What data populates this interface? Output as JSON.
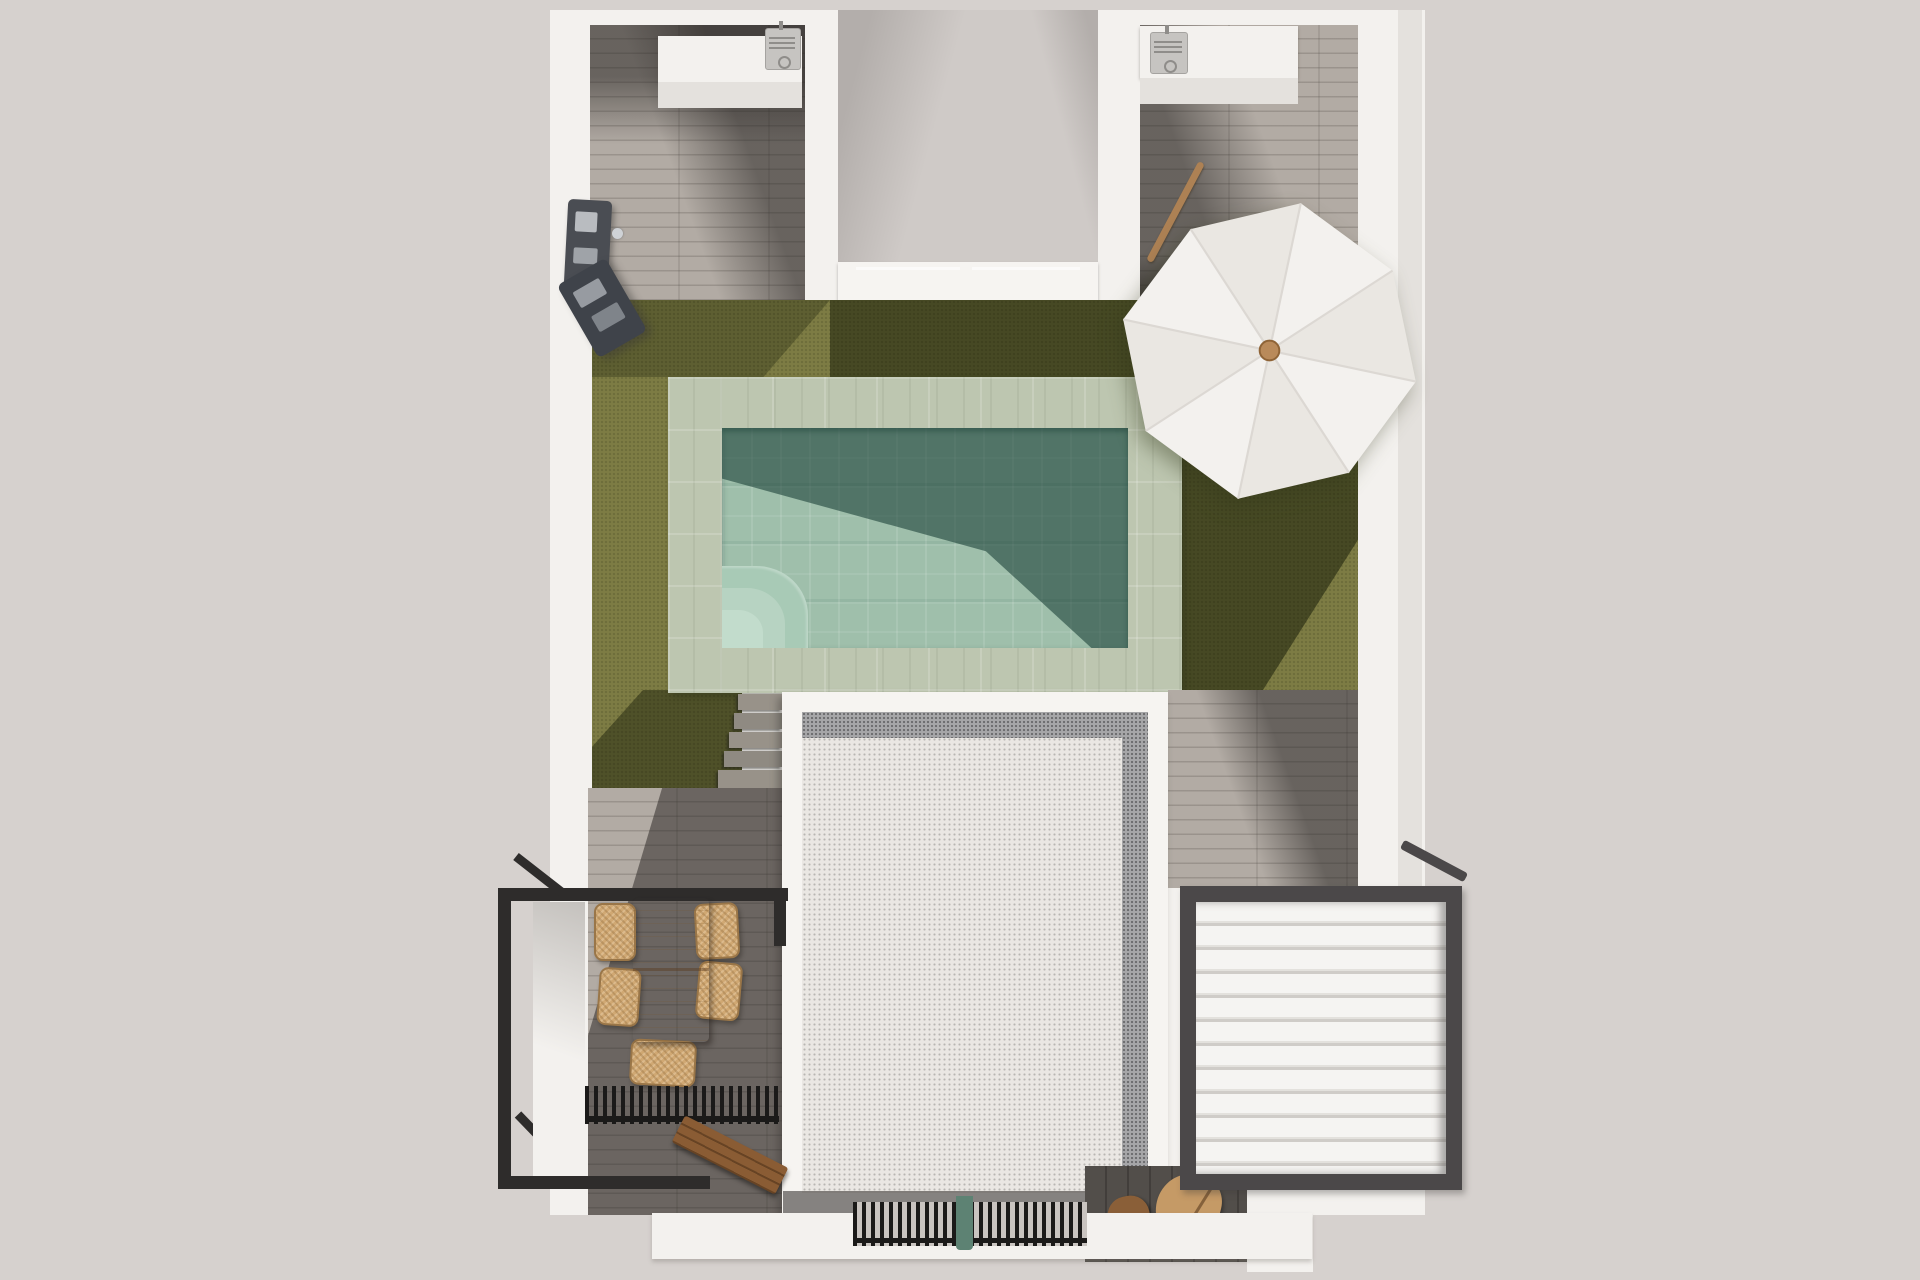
{
  "title": "Aerial 3D render — villa roof terrace with swimming pool, lawn, dining set, parasol and louvered pergola",
  "colors": {
    "ground": "#d6d1ce",
    "wall": "#f3f1ee",
    "wall-face": "#e4e1dd",
    "recess": "#cfcac7",
    "recess-shade": "#b3aeab",
    "parapet": "#f6f4f1",
    "wood": "#b2aba4",
    "wood-line": "rgba(80,74,68,0.25)",
    "shadow-dark": "rgba(36,33,31,0.52)",
    "lawn": "#7d7c44",
    "lawn-shadow": "rgba(16,22,4,0.5)",
    "pool-stone": "#bdc6b0",
    "pool-water": "#9fbfab",
    "pool-shadow": "rgba(10,48,40,0.52)",
    "pool-step": "#b7d3c2",
    "gravel": "#eae7e3",
    "gravel-dark": "#a6a6a8",
    "pergola-frame": "#4b4849",
    "louver": "#f5f4f2",
    "louver-gap": "#cfccc8",
    "railing": "#2e2c2b",
    "table-wood": "#c49a63",
    "chair-wicker": "#d0a873",
    "chair-edge": "#9a7648",
    "bench-wood": "#8a5c34",
    "board-light": "#c59a66",
    "board-dark": "#8a5f38",
    "grate": "#1b1a19",
    "grate-bg": "#c9c4c0",
    "teal-post": "#5d8273",
    "umbrella": "#f3f1ee",
    "umbrella-alt": "#eae7e2",
    "umbrella-rib": "#dcd8d3",
    "umbrella-knob": "#b98a5a",
    "ac-body": "#c6c4c1",
    "ac-dark": "#8f8d8a",
    "shower": "#4a4d53",
    "stick": "#ad8154",
    "step-wood": "#989289"
  },
  "scene": {
    "umbrella_segments": 8,
    "pergola_louver_count": 11,
    "dining_chair_count": 6,
    "ac_unit_count": 2,
    "stair_step_count": 5
  },
  "labels": {
    "building": "White villa walls (top view)",
    "courtyard": "Recessed entrance courtyard",
    "left_wing": "Left roof wing with deck",
    "right_wing": "Right roof wing with deck",
    "pool": "Swimming pool with stone surround",
    "lawn": "Artificial lawn",
    "umbrella": "White parasol",
    "gravel_roof": "Gravel flat roof",
    "pergola": "White louvered pergola with dark frame",
    "railing": "Black metal balcony railing",
    "table": "Wooden dining table",
    "chair": "Wicker dining chair",
    "bench": "Wooden bench",
    "grill": "Black slatted louver grill",
    "stairs": "Wooden steps to lower terrace",
    "shower": "Wall-mounted outdoor shower",
    "ac": "Air-conditioning unit",
    "grate": "Black ventilation grate",
    "boards": "Wooden boards in lightwell",
    "stick": "Wooden pole leaning on wall"
  }
}
